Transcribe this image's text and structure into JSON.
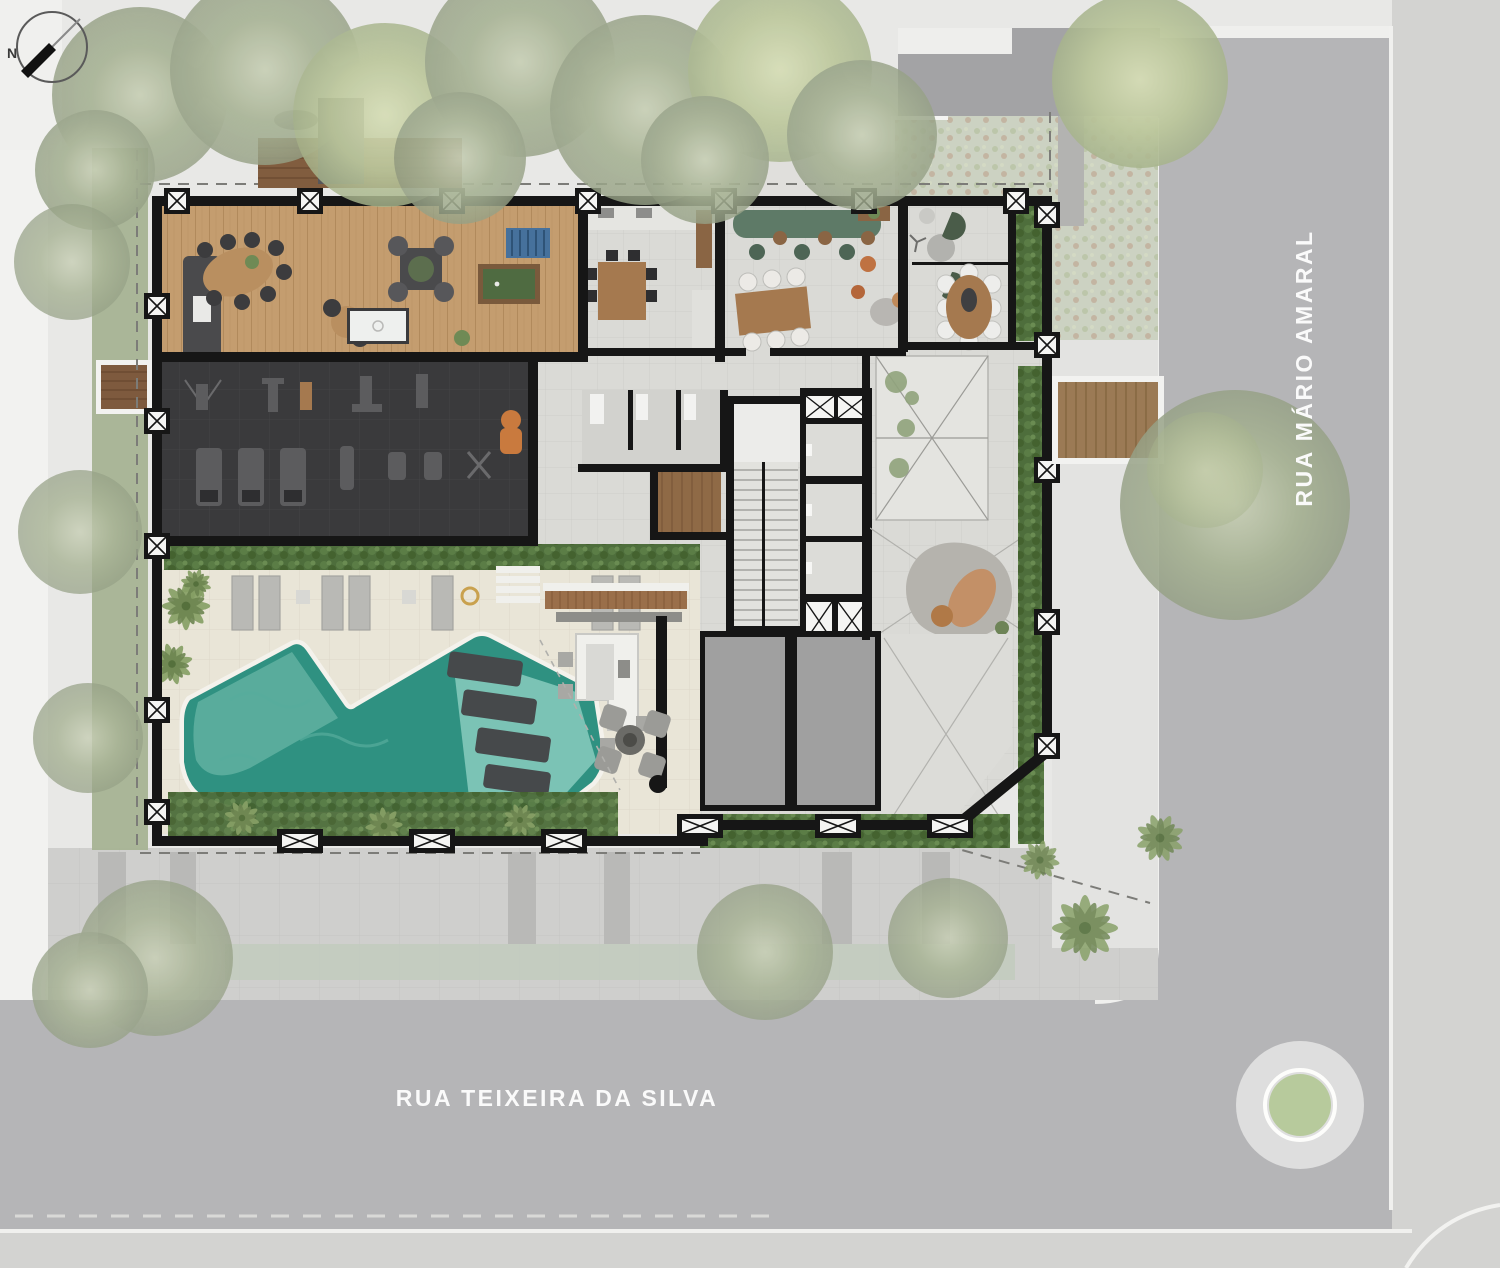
{
  "compass": {
    "label": "N"
  },
  "streets": {
    "right_label": "RUA MÁRIO AMARAL",
    "bottom_label": "RUA TEIXEIRA DA SILVA"
  },
  "palette": {
    "background": "#e8e8e6",
    "street": "#b5b5b7",
    "sidewalk": "#d3d3d1",
    "curb_white": "#f0f0ee",
    "walls": "#161616",
    "interior_floor": "#dadad6",
    "wood_floor": "#c49d6f",
    "deck_wood": "#916c49",
    "gym_floor": "#3a3a3c",
    "pool_water": "#2f9181",
    "pool_shallow": "#86c9b9",
    "pool_deck": "#e9e5d7",
    "hedge": "#4e6e3c",
    "canopy": "#aab695",
    "service_room": "#a0a0a0",
    "counter_green": "#5e7a67",
    "accent_chair": "#c97a3e",
    "roundabout_green": "#b7ca9c"
  }
}
